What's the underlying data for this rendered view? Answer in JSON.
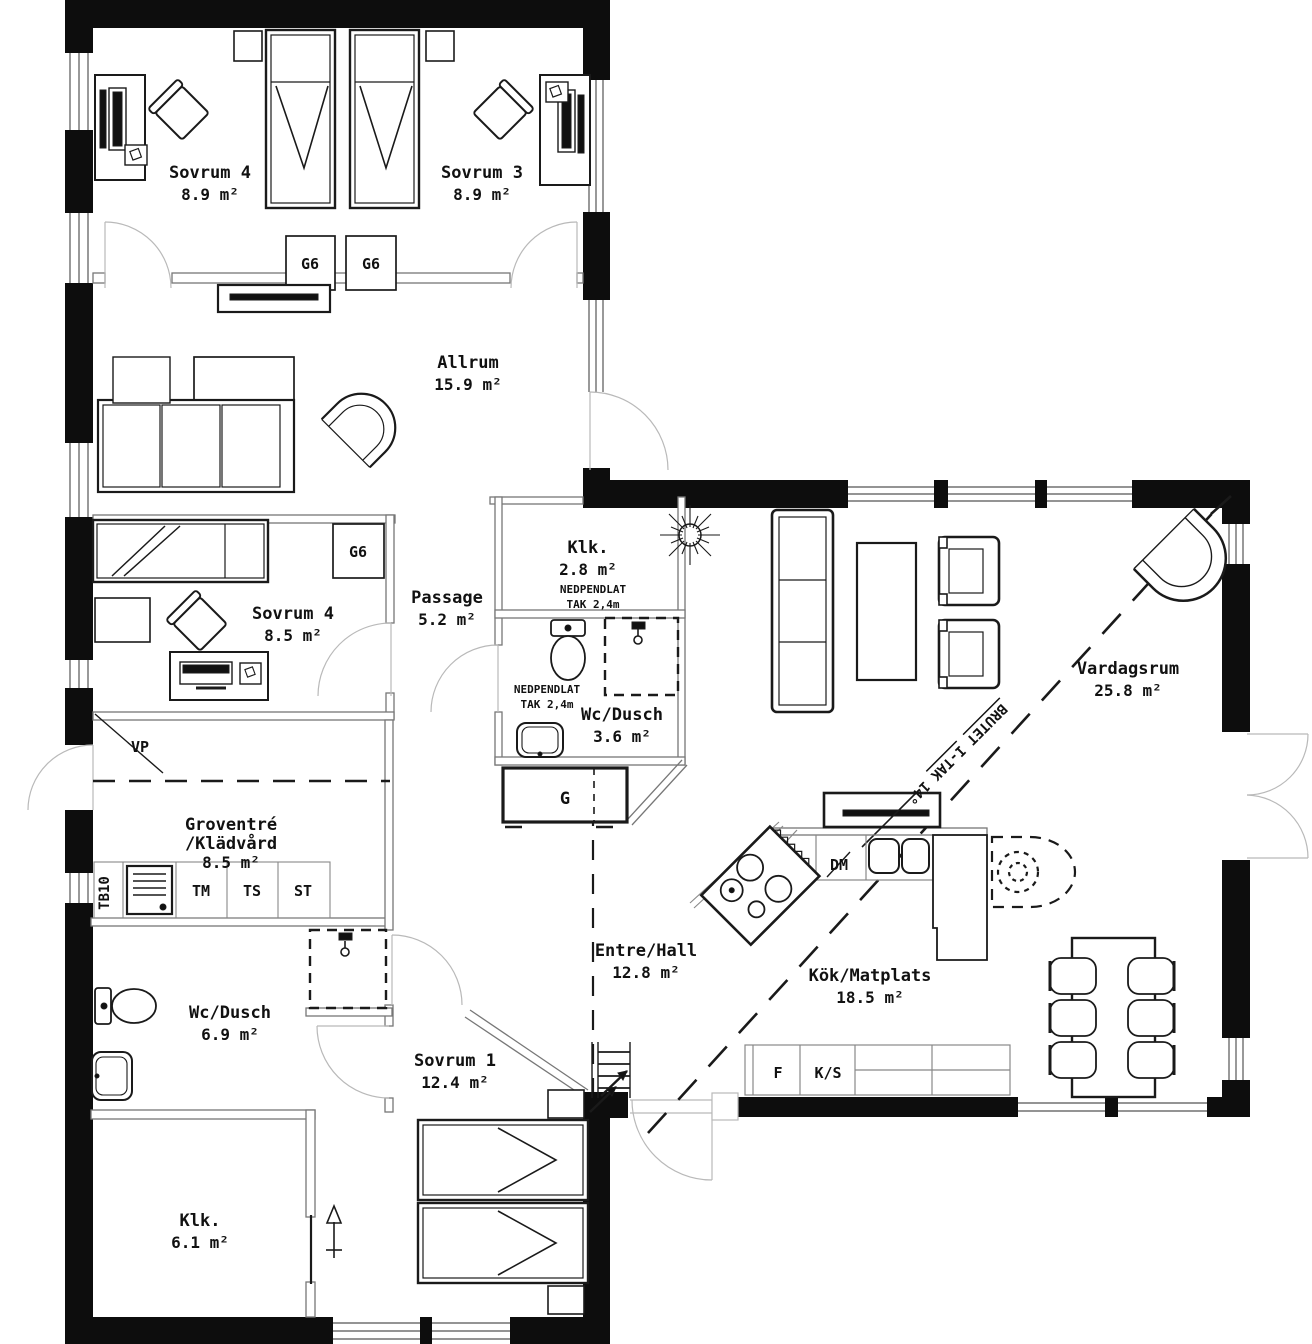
{
  "rooms": [
    {
      "name": "Sovrum 4",
      "area": "8.9 m²"
    },
    {
      "name": "Sovrum 3",
      "area": "8.9 m²"
    },
    {
      "name": "Allrum",
      "area": "15.9 m²"
    },
    {
      "name": "Klk.",
      "area": "2.8 m²"
    },
    {
      "name": "Passage",
      "area": "5.2 m²"
    },
    {
      "name": "Sovrum 4",
      "area": "8.5 m²"
    },
    {
      "name": "Wc/Dusch",
      "area": "3.6 m²"
    },
    {
      "name": "Groventré",
      "name2": "/Klädvård",
      "area": "8.5 m²"
    },
    {
      "name": "Wc/Dusch",
      "area": "6.9 m²"
    },
    {
      "name": "Entre/Hall",
      "area": "12.8 m²"
    },
    {
      "name": "Kök/Matplats",
      "area": "18.5 m²"
    },
    {
      "name": "Vardagsrum",
      "area": "25.8 m²"
    },
    {
      "name": "Sovrum 1",
      "area": "12.4 m²"
    },
    {
      "name": "Klk.",
      "area": "6.1 m²"
    }
  ],
  "fixtures": {
    "g6": "G6",
    "g": "G",
    "vp": "VP",
    "tb10": "TB10",
    "tm": "TM",
    "ts": "TS",
    "st": "ST",
    "dm": "DM",
    "f": "F",
    "ks": "K/S"
  },
  "notes": {
    "pendant_line1": "NEDPENDLAT",
    "pendant_line2": "TAK 2,4m",
    "ceiling": "BRUTET I-TAK 14°"
  }
}
